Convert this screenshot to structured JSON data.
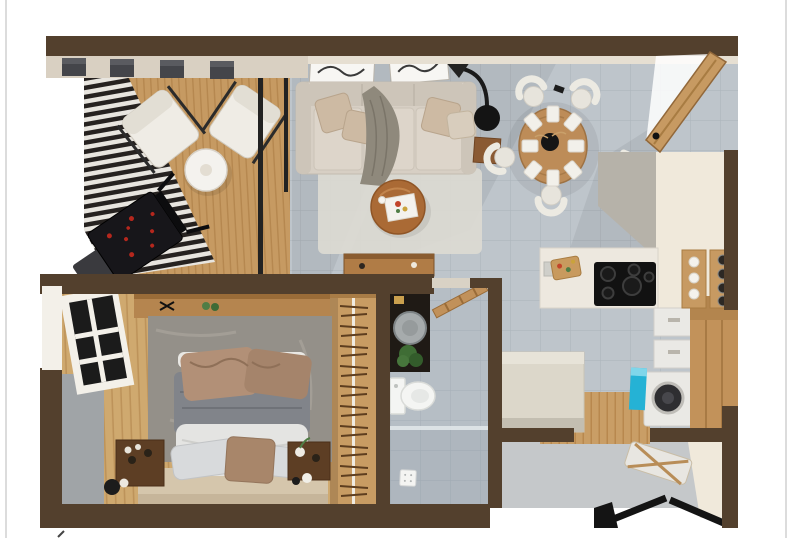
{
  "meta": {
    "description": "3D top-down architectural floor plan rendering of a one-bedroom apartment with balcony, living room, dining area, kitchen, bathroom, wardrobe corridor, bedroom and service balcony",
    "canvas": {
      "width": 800,
      "height": 538
    },
    "visible_text": "none",
    "artifact_mark": "tiny dark tick at lower-left margin"
  },
  "palette": {
    "background": "#ffffff",
    "border_gray": "#dcdcdc",
    "wall_brown": "#53402d",
    "wall_brown_dark": "#3f2f1f",
    "beige_wall_face": "#d9d0c2",
    "cream_wall": "#f0e9db",
    "deck_wood": "#c69a62",
    "bedroom_wood": "#cfa96f",
    "tile_gray": "#bec5cb",
    "screen_slat_dark": "#262220",
    "sofa_beige": "#d7cfc4",
    "cushion_tan": "#cdbaa3",
    "throw_gray": "#8f897c",
    "coffee_table_wood": "#aa6a35",
    "dining_table_wood": "#bd8c58",
    "chair_white": "#e7e4dc",
    "lamp_black": "#141414",
    "door_wood": "#c79a62",
    "counter_white": "#ede8df",
    "cooktop_black": "#121212",
    "island_beige": "#dcd7ca",
    "cabinet_wood": "#c2925a",
    "washer_white": "#eae9e5",
    "bin_blue": "#25b2d5",
    "vanity_black": "#1f1a15",
    "sink_gray": "#a6abac",
    "toilet_white": "#f4f5f3",
    "plant_green": "#3f6d35",
    "bed_duvet_gray": "#81848a",
    "bed_throw_tan": "#b29077",
    "bed_sheet_white": "#e4e4e2",
    "bed_platform_beige": "#d5c6ac",
    "pillow_brown": "#a8866a",
    "bedroom_rug_gray": "#949089",
    "nightstand_brown": "#5d3e24",
    "window_glass_black": "#1b1b1b",
    "railing_black": "#141414",
    "grill_coals_red": "#b5271d"
  },
  "scene": {
    "rooms": [
      {
        "name": "balcony",
        "items": [
          "slatted-privacy-screen",
          "lounge-chair-left",
          "lounge-chair-right",
          "round-white-table",
          "barbecue-grill",
          "ceiling-light-boxes"
        ]
      },
      {
        "name": "living-room",
        "items": [
          "sofa",
          "throw-blanket",
          "toss-pillows",
          "wall-art-frames",
          "arc-floor-lamp",
          "side-table",
          "area-rug",
          "round-coffee-table",
          "decor-tray",
          "console-table"
        ]
      },
      {
        "name": "dining-area",
        "items": [
          "round-dining-table",
          "centerpiece-bowl",
          "place-settings",
          "dining-chairs",
          "open-entry-door",
          "ceiling-spot"
        ]
      },
      {
        "name": "kitchen",
        "items": [
          "counter-run",
          "sink",
          "cutting-board",
          "cooktop",
          "kitchen-island",
          "drawer-units",
          "washing-machine",
          "blue-bin",
          "tall-wood-cabinet",
          "spice-racks",
          "wood-runner"
        ]
      },
      {
        "name": "bathroom",
        "items": [
          "vanity",
          "vessel-sink",
          "soap-dish",
          "potted-plant",
          "towel-ladder",
          "toilet",
          "glass-partition",
          "shower-drain"
        ]
      },
      {
        "name": "wardrobe-corridor",
        "items": [
          "wood-panel",
          "hanging-rail",
          "clothes-hangers"
        ]
      },
      {
        "name": "bedroom",
        "items": [
          "window",
          "gray-accent-wall",
          "headboard-shelf",
          "shelf-decor",
          "wall-sconce",
          "area-rug",
          "bed",
          "duvet",
          "throw",
          "pillows",
          "platform-base",
          "nightstand-left",
          "nightstand-right",
          "decor-objects"
        ]
      },
      {
        "name": "service-balcony",
        "items": [
          "drying-rack",
          "black-railing",
          "wall-wedge"
        ]
      }
    ]
  }
}
